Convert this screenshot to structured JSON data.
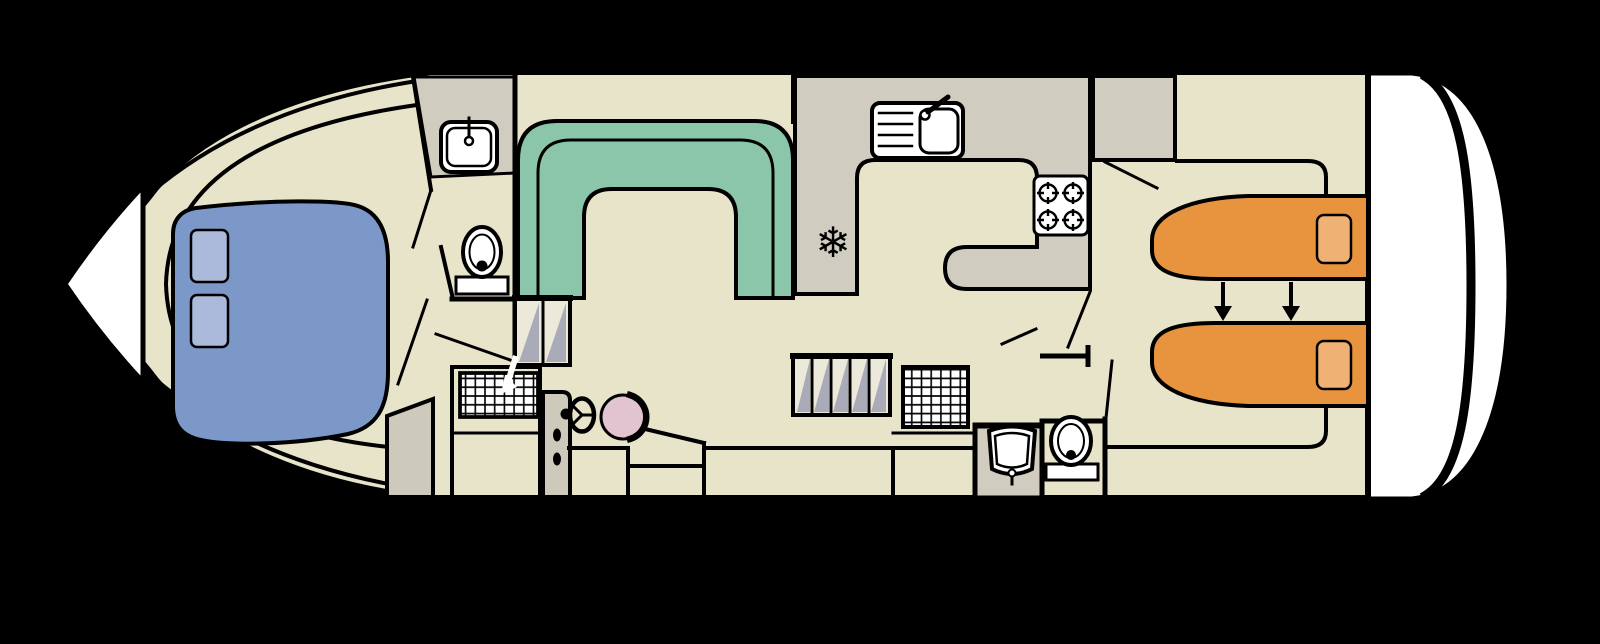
{
  "diagram": {
    "type": "boat-deck-floor-plan",
    "orientation": "bow-left-stern-right",
    "icons": {
      "snowflake": "❄"
    },
    "colors": {
      "background": "#000000",
      "hull_white": "#ffffff",
      "interior": "#e8e4ca",
      "wet_floor": "#d0cdc0",
      "counter": "#d0cdc0",
      "door": "#cdcabb",
      "step_tread": "#ece8da",
      "stair_shade": "#a9acb8",
      "sofa": "#8cc6aa",
      "double_bed": "#7c98c8",
      "double_bed_pillow": "#abbadb",
      "single_bed": "#e8943e",
      "single_bed_pillow": "#f0b274",
      "helm_seat": "#e2c4d0",
      "fixture_white": "#ffffff",
      "outline": "#000000"
    },
    "areas": [
      "bow-double-cabin",
      "forward-shower-room",
      "saloon-with-u-sofa",
      "helm-station",
      "galley",
      "aft-twin-cabin",
      "aft-shower-room"
    ],
    "fixtures": {
      "hob_burners": 4,
      "bow_berths": 2,
      "aft_berths": 2,
      "toilets": 2,
      "basins": 2,
      "galley_sinks": 1
    }
  }
}
